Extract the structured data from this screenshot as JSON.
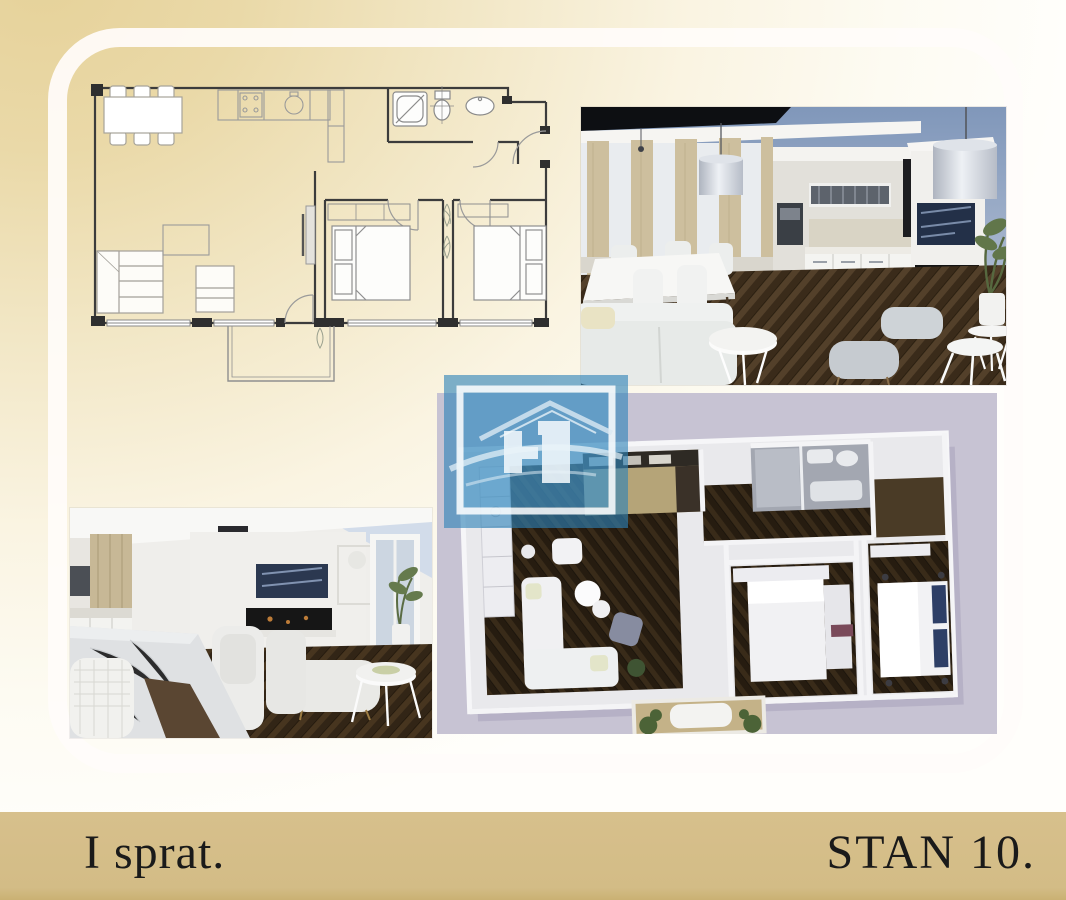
{
  "slide": {
    "footer": {
      "left_label": "I sprat.",
      "right_label": "STAN 10."
    },
    "colors": {
      "page_tint": "#e7d4a0",
      "footer_bar": "#d5be89",
      "footer_text": "#1a1a1a",
      "frame": "#ffffff",
      "watermark_blue": "#3787bd",
      "top_down_background": "#c7c3d3",
      "parquet_dark": "#3a2b1a",
      "sky_blue": "#8097ba"
    },
    "figures": [
      {
        "name": "floor-plan-2d"
      },
      {
        "name": "living-kitchen-render"
      },
      {
        "name": "dining-living-render"
      },
      {
        "name": "top-down-3d-render"
      },
      {
        "name": "watermark-logo"
      }
    ]
  }
}
